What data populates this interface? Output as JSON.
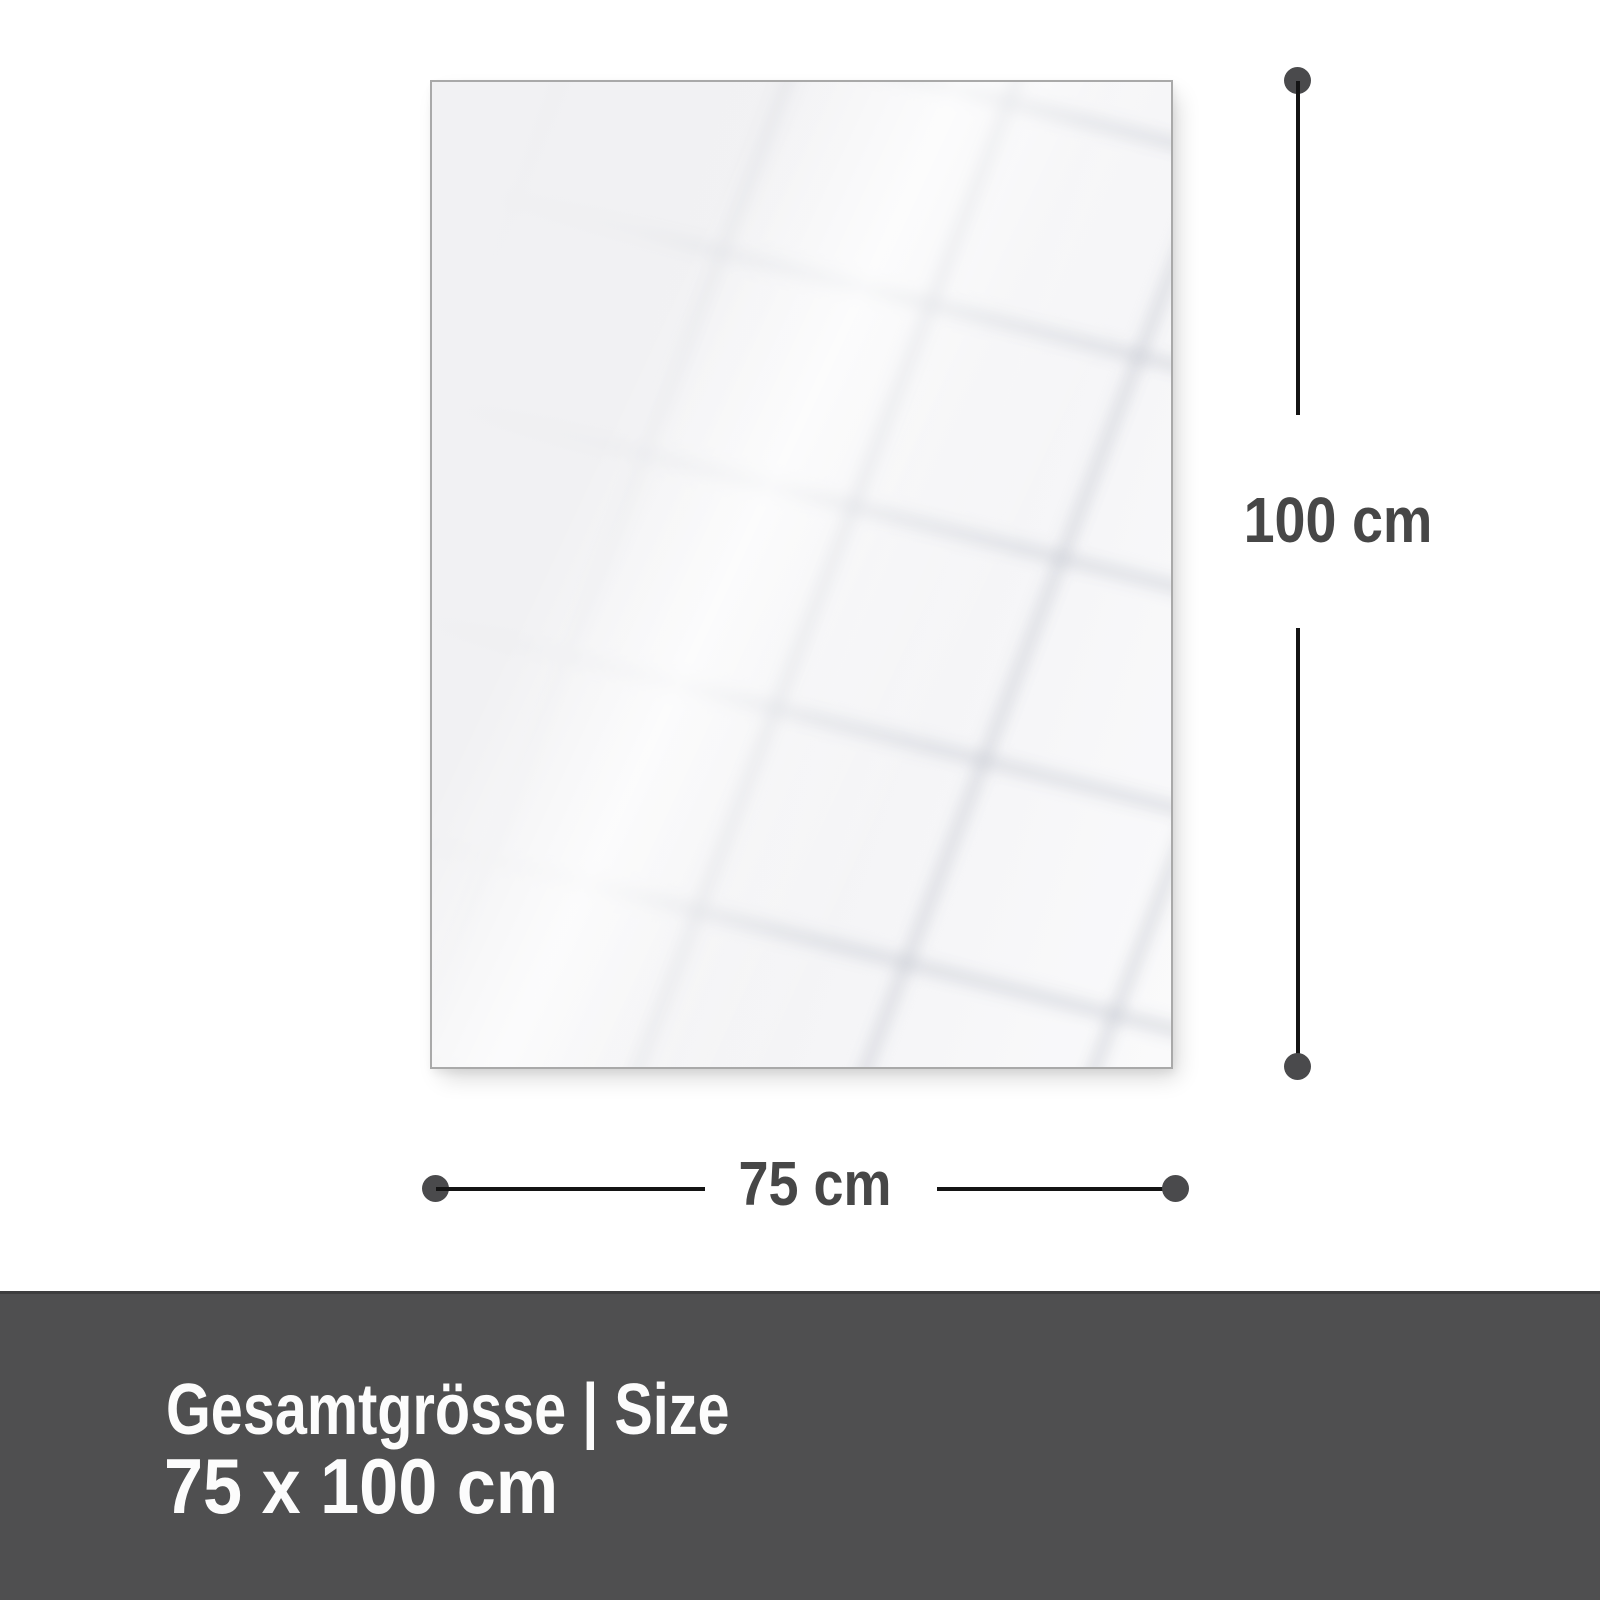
{
  "diagram": {
    "height_label": "100 cm",
    "width_label": "75 cm"
  },
  "footer": {
    "title": "Gesamtgrösse | Size",
    "size_text": "75 x 100 cm"
  },
  "colors": {
    "background": "#ffffff",
    "panel_fill": "#f2f2f4",
    "panel_border": "#a9a9a9",
    "dimension_line": "#141414",
    "dimension_dot": "#4a4a4c",
    "dimension_label": "#474747",
    "footer_background": "#4f4f50",
    "footer_text": "#fcfcfc"
  }
}
